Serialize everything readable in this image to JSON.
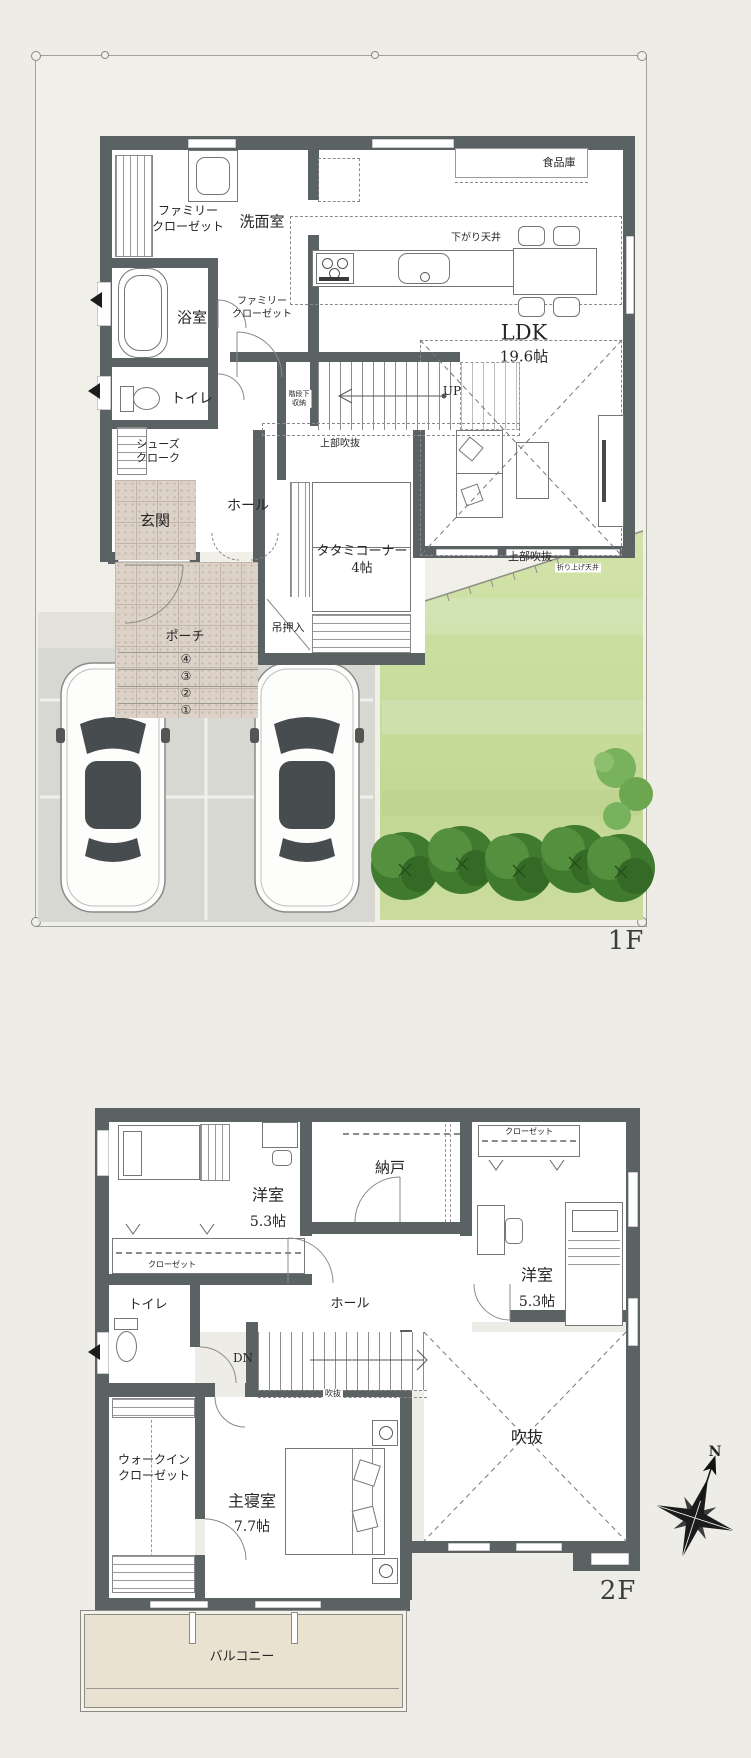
{
  "floor1": {
    "floor_label": "1F",
    "rooms": {
      "family_closet_upper": "ファミリー\nクローゼット",
      "washroom": "洗面室",
      "bathroom": "浴室",
      "family_closet_lower": "ファミリー\nクローゼット",
      "toilet": "トイレ",
      "shoes_cloak": "シューズ\nクローク",
      "entrance": "玄関",
      "hall": "ホール",
      "stair_storage": "階段下\n収納",
      "tatami_corner": "タタミコーナー\n4帖",
      "hanging_closet": "吊押入",
      "ldk_name": "LDK",
      "ldk_size": "19.6帖",
      "pantry": "食品庫",
      "porch": "ポーチ"
    },
    "annotations": {
      "up_label": "UP",
      "dropped_ceiling": "下がり天井",
      "upper_void_stairs": "上部吹抜",
      "upper_void_living": "上部吹抜",
      "raised_ceiling": "折り上げ天井",
      "porch_steps": [
        "④",
        "③",
        "②",
        "①"
      ]
    }
  },
  "floor2": {
    "floor_label": "2F",
    "rooms": {
      "bedroom_left_name": "洋室",
      "bedroom_left_size": "5.3帖",
      "closet_left": "クローゼット",
      "storage": "納戸",
      "closet_right": "クローゼット",
      "bedroom_right_name": "洋室",
      "bedroom_right_size": "5.3帖",
      "toilet": "トイレ",
      "hall": "ホール",
      "walk_in_closet": "ウォークイン\nクローゼット",
      "master_name": "主寝室",
      "master_size": "7.7帖",
      "void": "吹抜",
      "balcony": "バルコニー"
    },
    "annotations": {
      "dn_label": "DN",
      "void_small": "吹抜",
      "compass_north": "N"
    }
  },
  "colors": {
    "wall": "#5b6264",
    "tile": "#dcd2c8",
    "garden_green": "#c9dd9f",
    "hedge_green": "#3f7a2e",
    "driveway": "#d8d8d3",
    "balcony": "#e9e2d1",
    "background": "#edece6"
  }
}
